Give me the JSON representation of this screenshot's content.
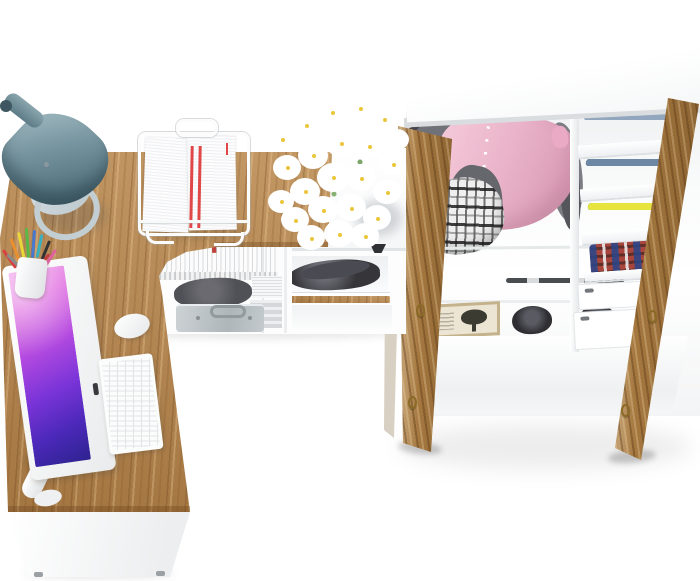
{
  "scene": {
    "description": "Top-view 3D product render of a furniture set: white and golden-oak corner computer desk with accessories, a low white shoe shelf with a white daisy bouquet, and a tall white wardrobe with two open oak doors full of clothes",
    "background": "#ffffff"
  },
  "palette": {
    "oak_wood": "#b6854d",
    "oak_door": "#a5783f",
    "white_furniture": "#ffffff",
    "panel_edge": "#dadde0",
    "lamp_teal_dark": "#42606b",
    "lamp_teal_light": "#a6bec5",
    "lamp_base_gray": "#c3ced3",
    "screen_magenta": "#e070e0",
    "screen_purple": "#7a34d8",
    "screen_blue": "#2f2390",
    "shirt_pink": "#eab4c9",
    "clothes_gray": "#6e6e75",
    "plaid_black": "#2a2a2a",
    "brass_hinge": "#8a6a26",
    "briefcase_silver": "#b7bfc3",
    "shoe_dark": "#35353a",
    "daisy_petal": "#ffffff",
    "daisy_center": "#e9c63a",
    "stem_green": "#86b072"
  },
  "desk": {
    "label": "oak corner desk top",
    "front_label": "white desk front panel",
    "lamp_label": "teal cone desk lamp",
    "monitor_label": "white all-in-one computer with purple abstract wallpaper",
    "keyboard_label": "white keyboard",
    "mouse_label": "white mouse",
    "pencil_cup_label": "white cup with colored pencils",
    "tray_label": "white wire document tray with papers"
  },
  "pencil_colors": [
    "#d84040",
    "#e89030",
    "#e8d838",
    "#58b848",
    "#4878d0",
    "#38b0c0",
    "#333333",
    "#e060a0",
    "#8a8a8a",
    "#c04040"
  ],
  "shelf_unit": {
    "label": "white open shelf unit",
    "books_label": "row of white catalogs with colored bookmarks",
    "book_tab_colors": [
      "#e040a0",
      "#e8d040",
      "#4098e0",
      "#e04040",
      "#8040c0",
      "#40c060",
      "#e08030",
      "#d84898",
      "#4060d0",
      "#e8d040",
      "#50b8b0",
      "#c04040"
    ],
    "bag_label": "dark pouch",
    "briefcase_label": "silver briefcase",
    "shoes_label": "black shoes on shelf",
    "board_label": "oak shelf board"
  },
  "flowers": {
    "label": "white daisy bouquet on shelf top"
  },
  "wardrobe": {
    "label": "white wardrobe with open oak doors",
    "top_label": "wardrobe white top panel",
    "shirt_label": "pink button-up shirt on hanger",
    "gray_clothes_label": "gray hanging garments",
    "basket_label": "black and white plaid basket",
    "piles": [
      {
        "label": "light denim and tees stack",
        "colors": [
          "#c9ced3",
          "#2f63b4",
          "#4a70a8",
          "#92a6bd"
        ]
      },
      {
        "label": "dark jeans stack",
        "colors": [
          "#93a9bf",
          "#2e3c4e",
          "#46607a",
          "#6c88a4"
        ]
      },
      {
        "label": "colorful folded tees stack",
        "colors": [
          "#8a55c8",
          "#2fb3ab",
          "#d85898",
          "#4fc046",
          "#e8e43e"
        ]
      }
    ],
    "blanket_label": "multicolor plaid blanket",
    "box_label": "decor box with tree print",
    "boots_label": "dark ankle boots",
    "drawers_label": "white internal drawers",
    "door_left_label": "open oak door (left)",
    "door_right_label": "open oak door (right)",
    "hinge_label": "brass hinge"
  }
}
